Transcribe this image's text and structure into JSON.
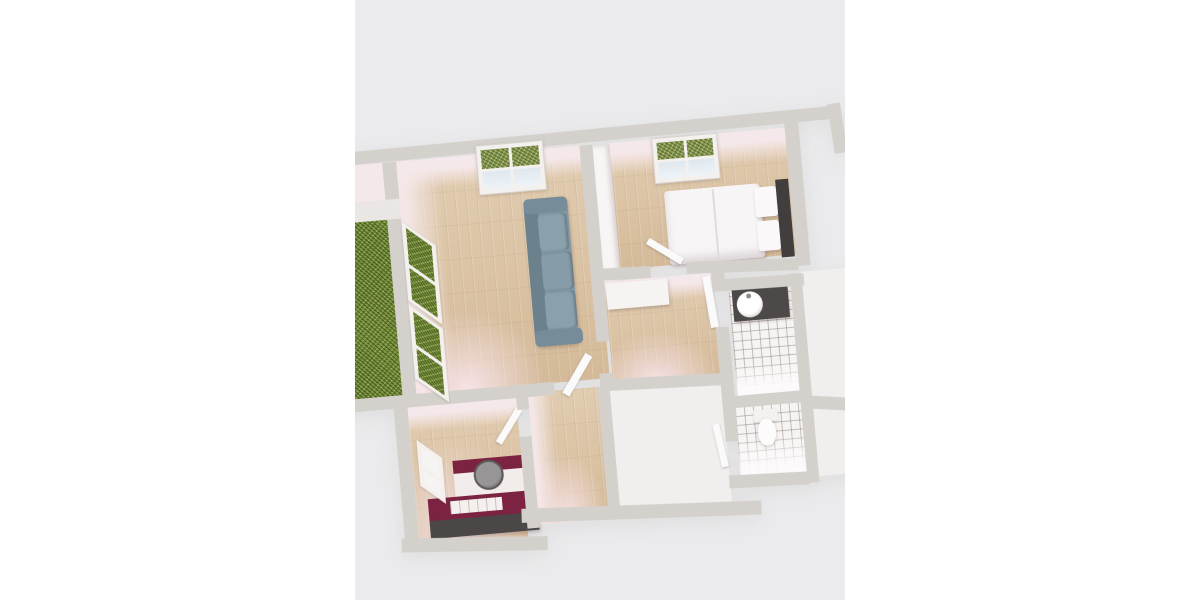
{
  "scene": {
    "type": "3d-floorplan-render",
    "description": "Top-down 3D render of an apartment floor plan, tilted ~5 degrees, letterboxed in a gray viewport on a white page",
    "rotation_deg": -5,
    "viewport": {
      "x": 355,
      "y": 0,
      "width": 490,
      "height": 600
    }
  },
  "colors": {
    "page-bg": "#ffffff",
    "scene-bg": "#ebebed",
    "wall": "#d4d1cd",
    "face-pink": "#f5e8ea",
    "wood": "#d8bf9e",
    "hedge": "#7c963d",
    "tile": "#f6f4f3",
    "white-room": "#f1eeee",
    "frame": "#f3f0ee",
    "leaf": "#fbfafa",
    "sofa": "#8097a3",
    "sofa-dark": "#6b828d",
    "bed-white": "#f7f5f6",
    "headboard": "#413e3d",
    "vanity": "#4d4949",
    "maroon": "#7d2342",
    "counter-white": "#f2ecea",
    "counter-dark": "#4b4747",
    "steel": "#8c8a8a"
  },
  "rooms": [
    {
      "id": "living-room",
      "floor": "wood",
      "furniture": [
        "sofa"
      ]
    },
    {
      "id": "bedroom",
      "floor": "wood",
      "furniture": [
        "double-bed",
        "wardrobe"
      ]
    },
    {
      "id": "hallway",
      "floor": "wood",
      "furniture": [
        "sideboard"
      ]
    },
    {
      "id": "corridor",
      "floor": "wood",
      "furniture": []
    },
    {
      "id": "kitchen",
      "floor": "wood",
      "furniture": [
        "counter-with-round-sink",
        "island-counter"
      ]
    },
    {
      "id": "bathroom",
      "floor": "tile",
      "furniture": [
        "vanity-with-round-basin"
      ]
    },
    {
      "id": "wc",
      "floor": "tile",
      "furniture": [
        "toilet"
      ]
    },
    {
      "id": "balcony",
      "floor": "hedge-green",
      "furniture": []
    }
  ],
  "windows": [
    {
      "id": "living-room-top-window",
      "panes": "2x2",
      "view": "greenery-and-sky"
    },
    {
      "id": "bedroom-top-window",
      "panes": "2x2",
      "view": "greenery-and-sky"
    },
    {
      "id": "balcony-door-upper",
      "view": "hedge"
    },
    {
      "id": "balcony-door-lower",
      "view": "hedge"
    },
    {
      "id": "kitchen-side-window",
      "view": "light"
    }
  ],
  "doors": [
    "bedroom-door-open",
    "living-room-door-open",
    "kitchen-door-open",
    "bathroom-door-open",
    "wc-door-open"
  ]
}
